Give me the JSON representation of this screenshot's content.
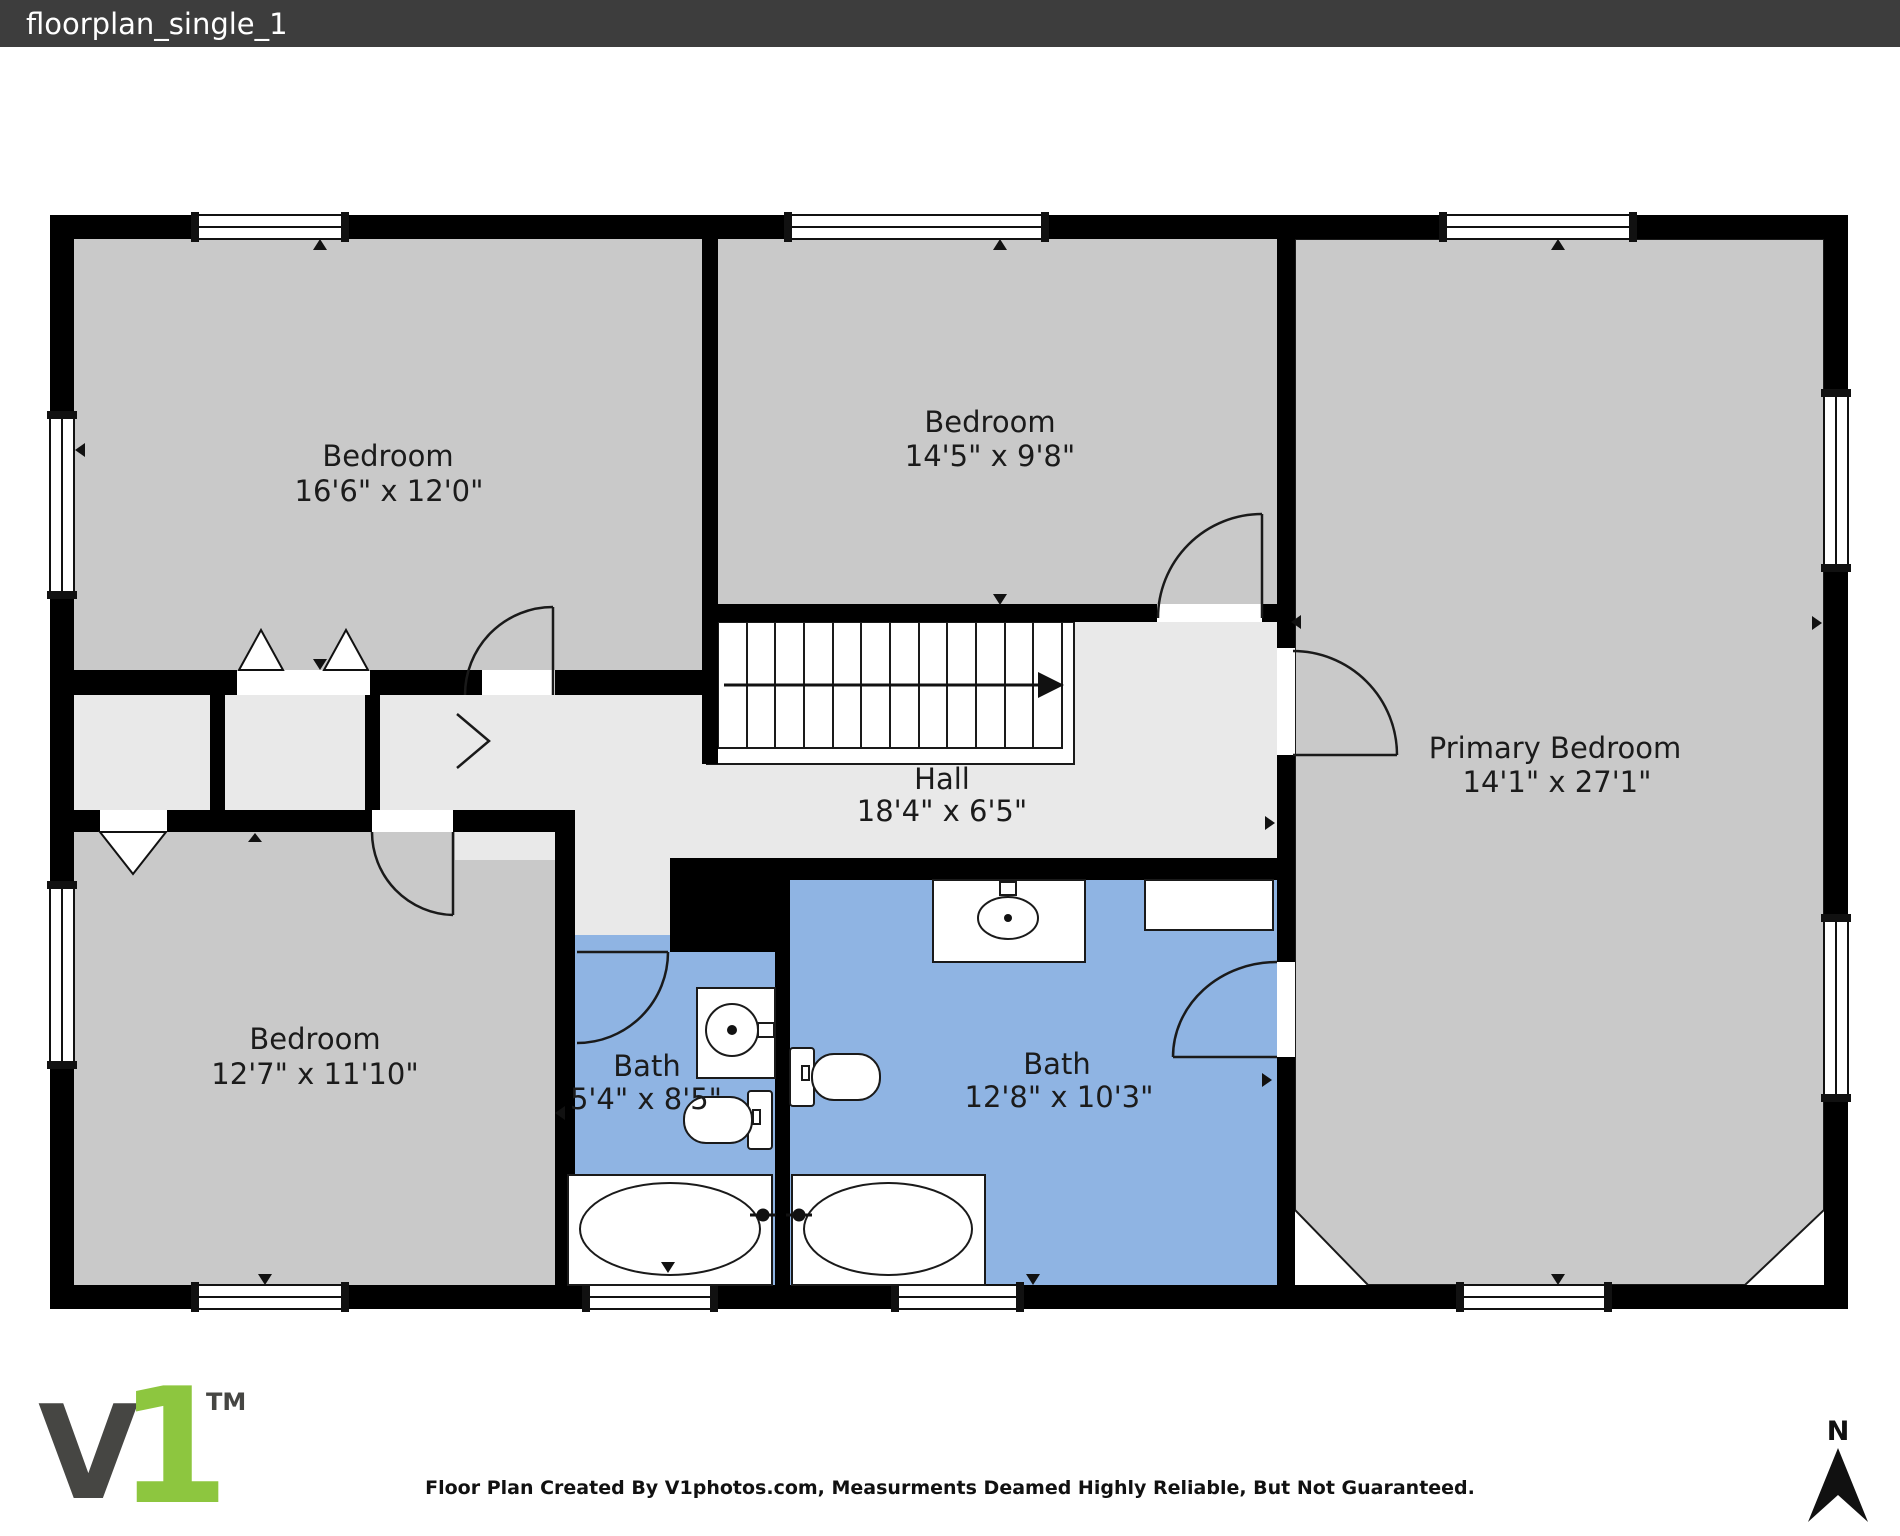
{
  "window": {
    "title": "floorplan_single_1"
  },
  "colors": {
    "titlebar": "#3d3d3d",
    "wall": "#000000",
    "bedroom": "#c9c9c9",
    "hall": "#e9e9e9",
    "bath": "#8fb4e3",
    "logo_dark": "#464643",
    "logo_green": "#8dc63f"
  },
  "rooms": [
    {
      "id": "bedroom-top-left",
      "name": "Bedroom",
      "dims": "16'6\" x 12'0\""
    },
    {
      "id": "bedroom-top-middle",
      "name": "Bedroom",
      "dims": "14'5\" x 9'8\""
    },
    {
      "id": "primary-bedroom",
      "name": "Primary Bedroom",
      "dims": "14'1\" x 27'1\""
    },
    {
      "id": "bedroom-bottom-left",
      "name": "Bedroom",
      "dims": "12'7\" x 11'10\""
    },
    {
      "id": "hall",
      "name": "Hall",
      "dims": "18'4\" x 6'5\""
    },
    {
      "id": "bath-small",
      "name": "Bath",
      "dims": "5'4\" x 8'5\""
    },
    {
      "id": "bath-large",
      "name": "Bath",
      "dims": "12'8\" x 10'3\""
    }
  ],
  "footer": {
    "disclaimer": "Floor Plan Created By V1photos.com, Measurments Deamed Highly Reliable, But Not Guaranteed.",
    "compass_label": "N",
    "logo": {
      "v": "V",
      "one": "1",
      "tm": "TM"
    }
  }
}
